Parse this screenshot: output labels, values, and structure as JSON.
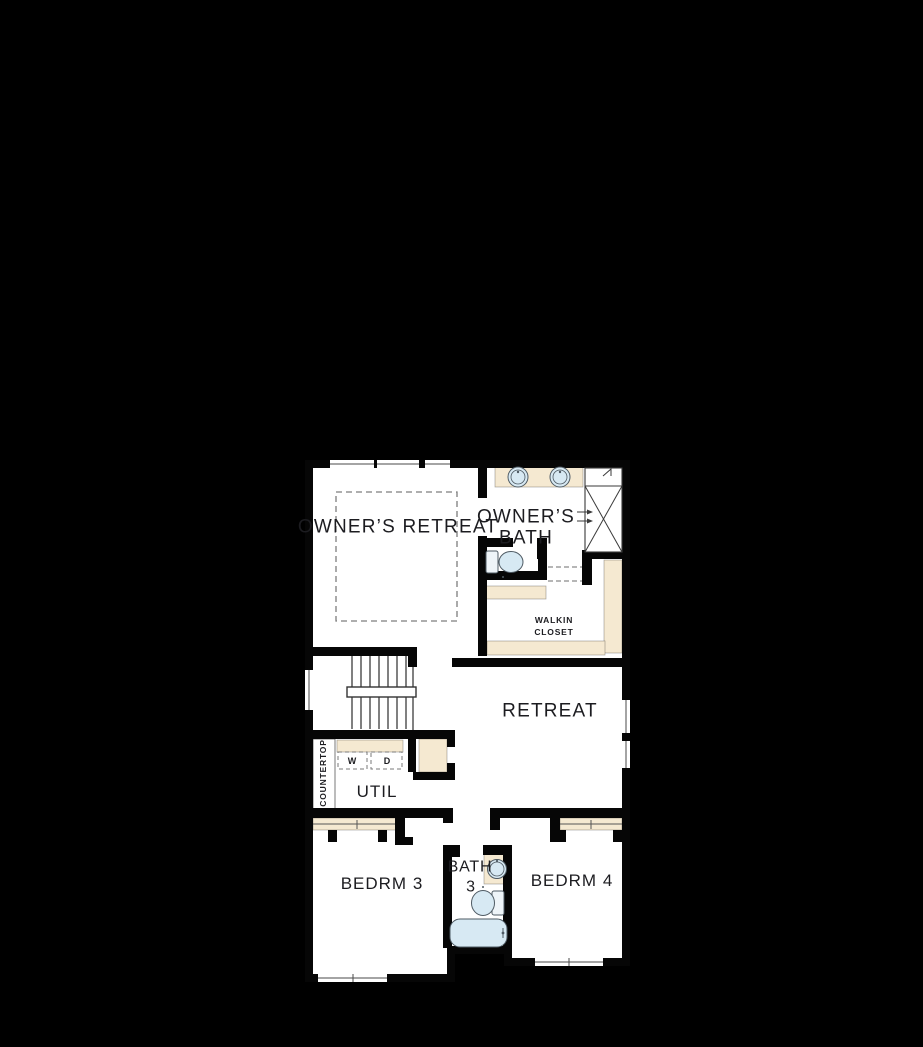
{
  "canvas": {
    "background_color": "#000000",
    "floor_color": "#ffffff",
    "wall_color": "#060606",
    "casework_color": "#f5e9d1",
    "fixture_color": "#d7e9f3",
    "label_color": "#1c1c20"
  },
  "rooms": {
    "owners_retreat": {
      "label": "OWNER’S RETREAT"
    },
    "owners_bath": {
      "label_line1": "OWNER’S",
      "label_line2": "BATH"
    },
    "walkin_closet": {
      "label_line1": "WALKIN",
      "label_line2": "CLOSET"
    },
    "retreat": {
      "label": "RETREAT"
    },
    "util": {
      "label": "UTIL"
    },
    "bedroom3": {
      "label": "BEDRM 3"
    },
    "bath3": {
      "label_line1": "BATH",
      "label_line2": "3"
    },
    "bedroom4": {
      "label": "BEDRM 4"
    }
  },
  "annotations": {
    "countertop": "COUNTERTOP",
    "washer": "W",
    "dryer": "D"
  },
  "fixtures": [
    "double-vanity-sink",
    "walk-in-shower",
    "water-closet-toilet",
    "closet-shelving",
    "staircase",
    "washer-dryer-boxes",
    "linen-closet",
    "bath3-sink",
    "bath3-toilet",
    "bathtub",
    "bedroom-closet-rods",
    "windows",
    "tray-ceiling-dashed-outline"
  ]
}
